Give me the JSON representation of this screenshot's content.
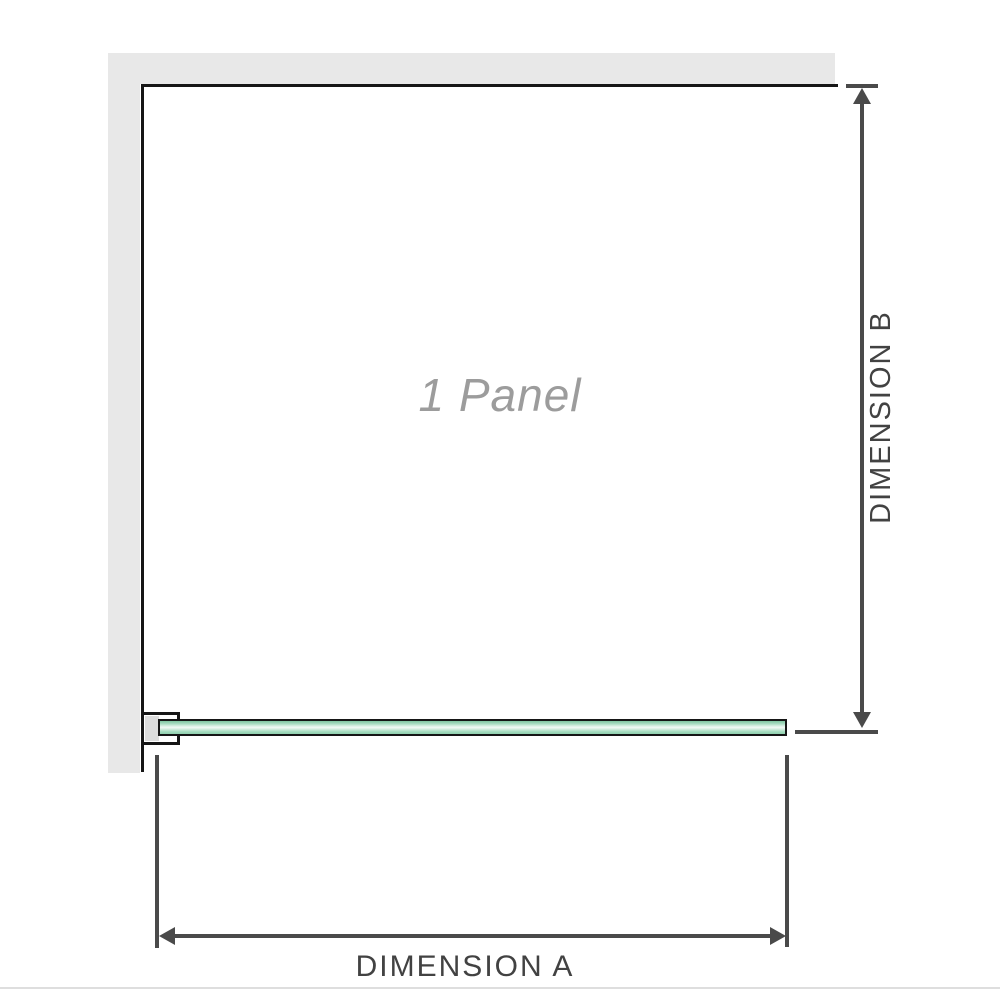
{
  "diagram": {
    "panel_label": "1 Panel",
    "dimension_a_label": "DIMENSION A",
    "dimension_b_label": "DIMENSION B"
  },
  "colors": {
    "wall_gray": "#e8e8e8",
    "panel_outline": "#161616",
    "dimension_lines": "#4a4a4a",
    "dimension_text": "#424242",
    "panel_label_text": "#9c9c9c",
    "glass_green_dark": "#7fc5a0",
    "glass_green_light": "#f2faf6",
    "bracket_pad_gray": "#dcdcdc",
    "bottom_divider": "#dedede"
  }
}
